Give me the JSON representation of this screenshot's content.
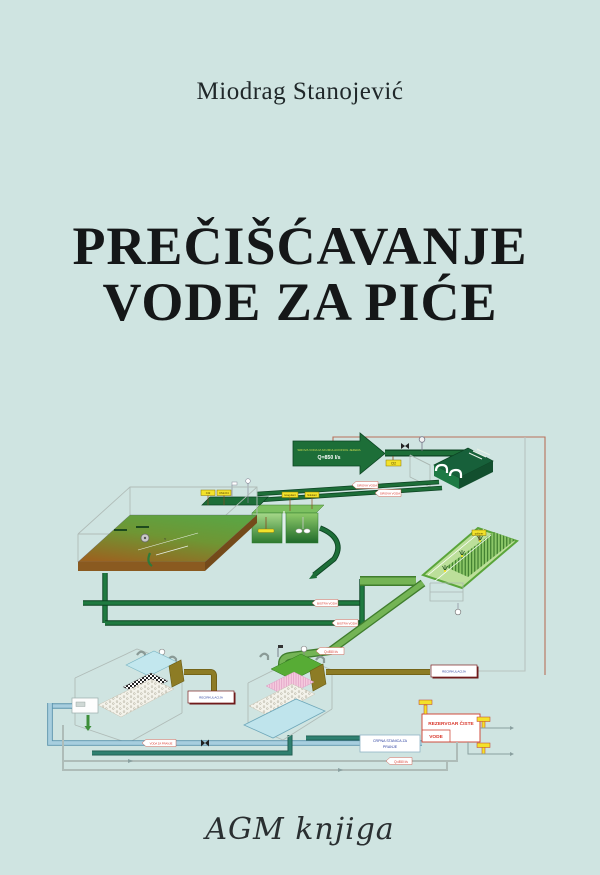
{
  "cover": {
    "author": "Miodrag Stanojević",
    "title_line1": "PREČIŠĆAVANJE",
    "title_line2": "VODE ZA PIĆE",
    "publisher": "AGM knjiga"
  },
  "colors": {
    "background": "#cfe4e1",
    "title_text": "#151718",
    "pipe_dark_green": "#1d6e38",
    "pipe_light_green": "#74b455",
    "pipe_olive": "#8d7c25",
    "pipe_teal": "#2f8070",
    "pipe_blue": "#a7cede",
    "label_red_text": "#d8362a",
    "label_blue_text": "#2a3f9e",
    "sign_yellow": "#f3e22b",
    "recirc_border_maroon": "#6b1a1a",
    "loop_line_brown": "#b8705a"
  },
  "diagram": {
    "inflow": {
      "line1": "SIROVA VODA IZ AKUMULACIONOG JEZERA",
      "line2": "Q=850 l/s"
    },
    "labels": {
      "raw1": "SIROVA VODA",
      "raw2": "SIROVA VODA",
      "clar1": "BISTRA VODA",
      "clar2": "BISTRA VODA",
      "flow1": "Q=850 l/s",
      "flow3": "Q=850 l/s",
      "wash": "VODA ZA PRANJE",
      "recirc1": "RECIRKULACIJA",
      "recirc2": "RECIRKULACIJA",
      "pump_line1": "CRPNA STANICA ZA",
      "pump_line2": "PRANJE",
      "res_line1": "REZERVOAR ČISTE",
      "res_line2": "VODE"
    },
    "signs": {
      "s1": "Cl2",
      "s2": "KMnO4",
      "s3": "koagulant",
      "s4": "flokulant",
      "s5": "Cl2",
      "s6": "polimer"
    }
  }
}
